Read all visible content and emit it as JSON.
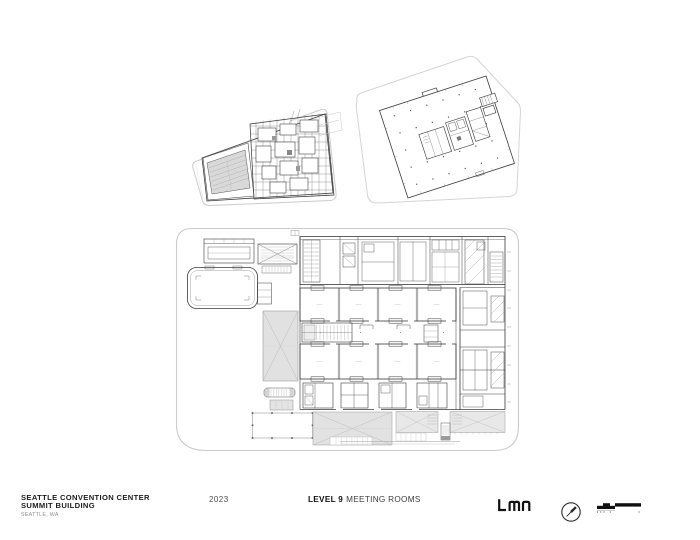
{
  "sheet": {
    "background": "#ffffff",
    "ink_color": "#2e2e2e",
    "boundary_color": "#cbcbcb",
    "shade_color": "#e2e2e2"
  },
  "title_block": {
    "project_name_line1": "SEATTLE CONVENTION CENTER",
    "project_name_line2": "SUMMIT BUILDING",
    "location": "SEATTLE, WA",
    "year": "2023",
    "level_label": "LEVEL 9",
    "sheet_name": "MEETING ROOMS",
    "firm_logo_text": "LMN"
  },
  "icons": {
    "north_arrow": "north-arrow-compass",
    "scale_bar": "graphic-scale-bar"
  }
}
